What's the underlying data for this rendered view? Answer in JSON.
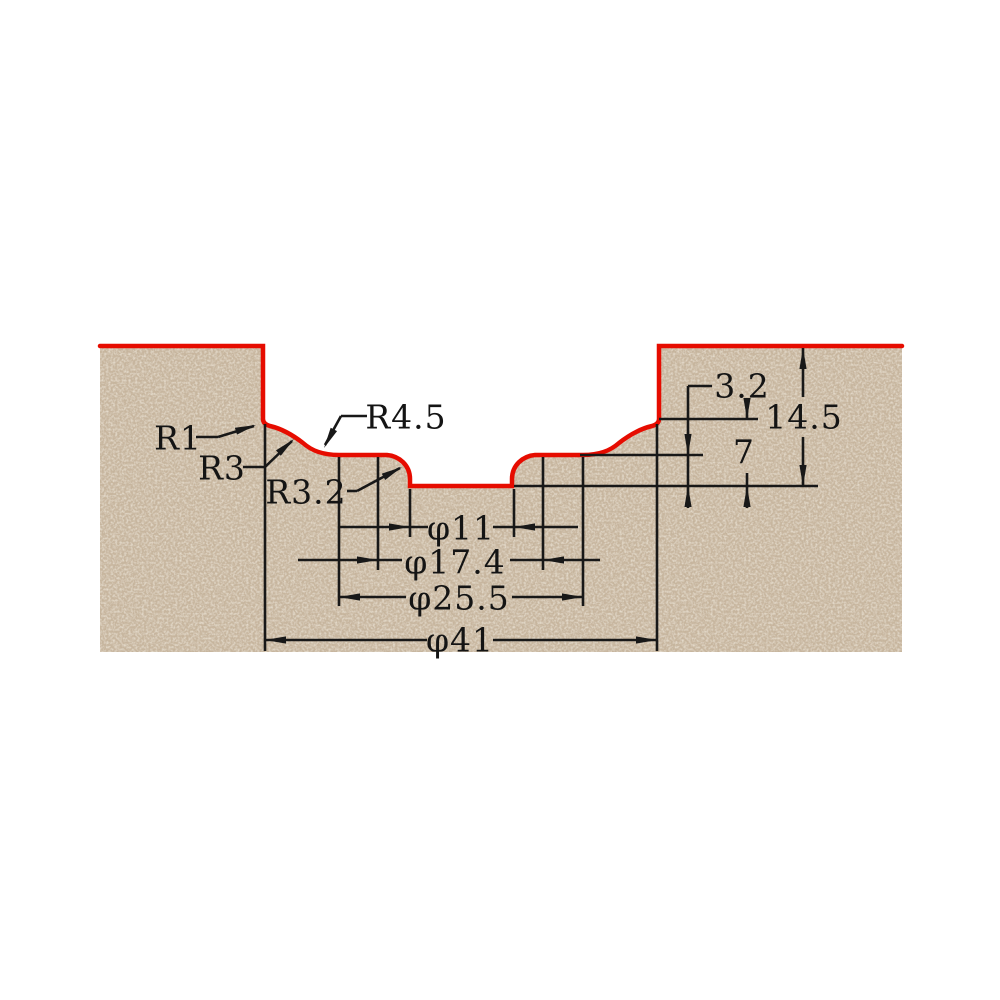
{
  "drawing": {
    "name": "Router bit cutting profile cross-section",
    "colors": {
      "profile_outline": "#e60c00",
      "material": "#c9b7a0",
      "dimension_lines": "#181818",
      "background": "#ffffff"
    },
    "radius_labels": {
      "r1": "R1",
      "r3": "R3",
      "r3_2": "R3.2",
      "r4_5": "R4.5"
    },
    "diameter_dimensions": {
      "phi11": "φ11",
      "phi17_4": "φ17.4",
      "phi25_5": "φ25.5",
      "phi41": "φ41"
    },
    "depth_dimensions": {
      "d3_2": "3.2",
      "d14_5": "14.5",
      "d7": "7"
    }
  }
}
